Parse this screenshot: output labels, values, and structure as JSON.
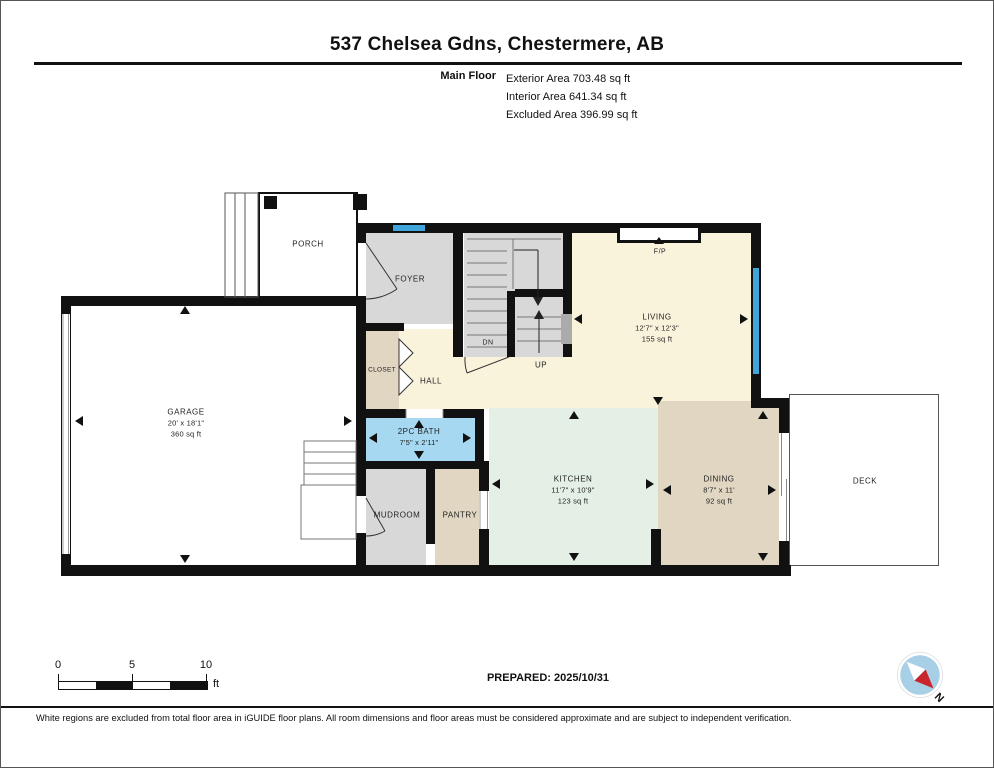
{
  "header": {
    "title": "537 Chelsea Gdns, Chestermere, AB",
    "floor_label": "Main Floor",
    "stats": [
      "Exterior Area 703.48 sq ft",
      "Interior Area 641.34 sq ft",
      "Excluded Area 396.99 sq ft"
    ]
  },
  "plan": {
    "rooms": {
      "porch": {
        "label": "PORCH"
      },
      "foyer": {
        "label": "FOYER"
      },
      "closet": {
        "label": "CLOSET"
      },
      "hall": {
        "label": "HALL"
      },
      "stairs_dn": {
        "label": "DN"
      },
      "stairs_up": {
        "label": "UP"
      },
      "fireplace": {
        "label": "F/P"
      },
      "living": {
        "label": "LIVING",
        "dims": "12'7\" x 12'3\"",
        "area": "155 sq ft"
      },
      "garage": {
        "label": "GARAGE",
        "dims": "20' x 18'1\"",
        "area": "360 sq ft"
      },
      "bath": {
        "label": "2PC BATH",
        "dims": "7'5\" x 2'11\""
      },
      "mudroom": {
        "label": "MUDROOM"
      },
      "pantry": {
        "label": "PANTRY"
      },
      "kitchen": {
        "label": "KITCHEN",
        "dims": "11'7\" x 10'9\"",
        "area": "123 sq ft"
      },
      "dining": {
        "label": "DINING",
        "dims": "8'7\" x 11'",
        "area": "92 sq ft"
      },
      "deck": {
        "label": "DECK"
      }
    }
  },
  "scale_bar": {
    "ticks": [
      "0",
      "5",
      "10"
    ],
    "unit": "ft"
  },
  "footer": {
    "prepared": "PREPARED: 2025/10/31",
    "compass_label": "N",
    "disclaimer": "White regions are excluded from total floor area in iGUIDE floor plans. All room dimensions and floor areas must be considered approximate and are subject to independent verification."
  },
  "colors": {
    "cream": "#FAF3DC",
    "mint": "#E4EFE6",
    "tan": "#E0D6C2",
    "room_gray": "#D8D8D8",
    "bath_blue": "#A6D9F1",
    "window_blue": "#3FA5DA",
    "wall": "#111111",
    "compass_blue": "#A7CFE5",
    "compass_red": "#C9252C"
  }
}
